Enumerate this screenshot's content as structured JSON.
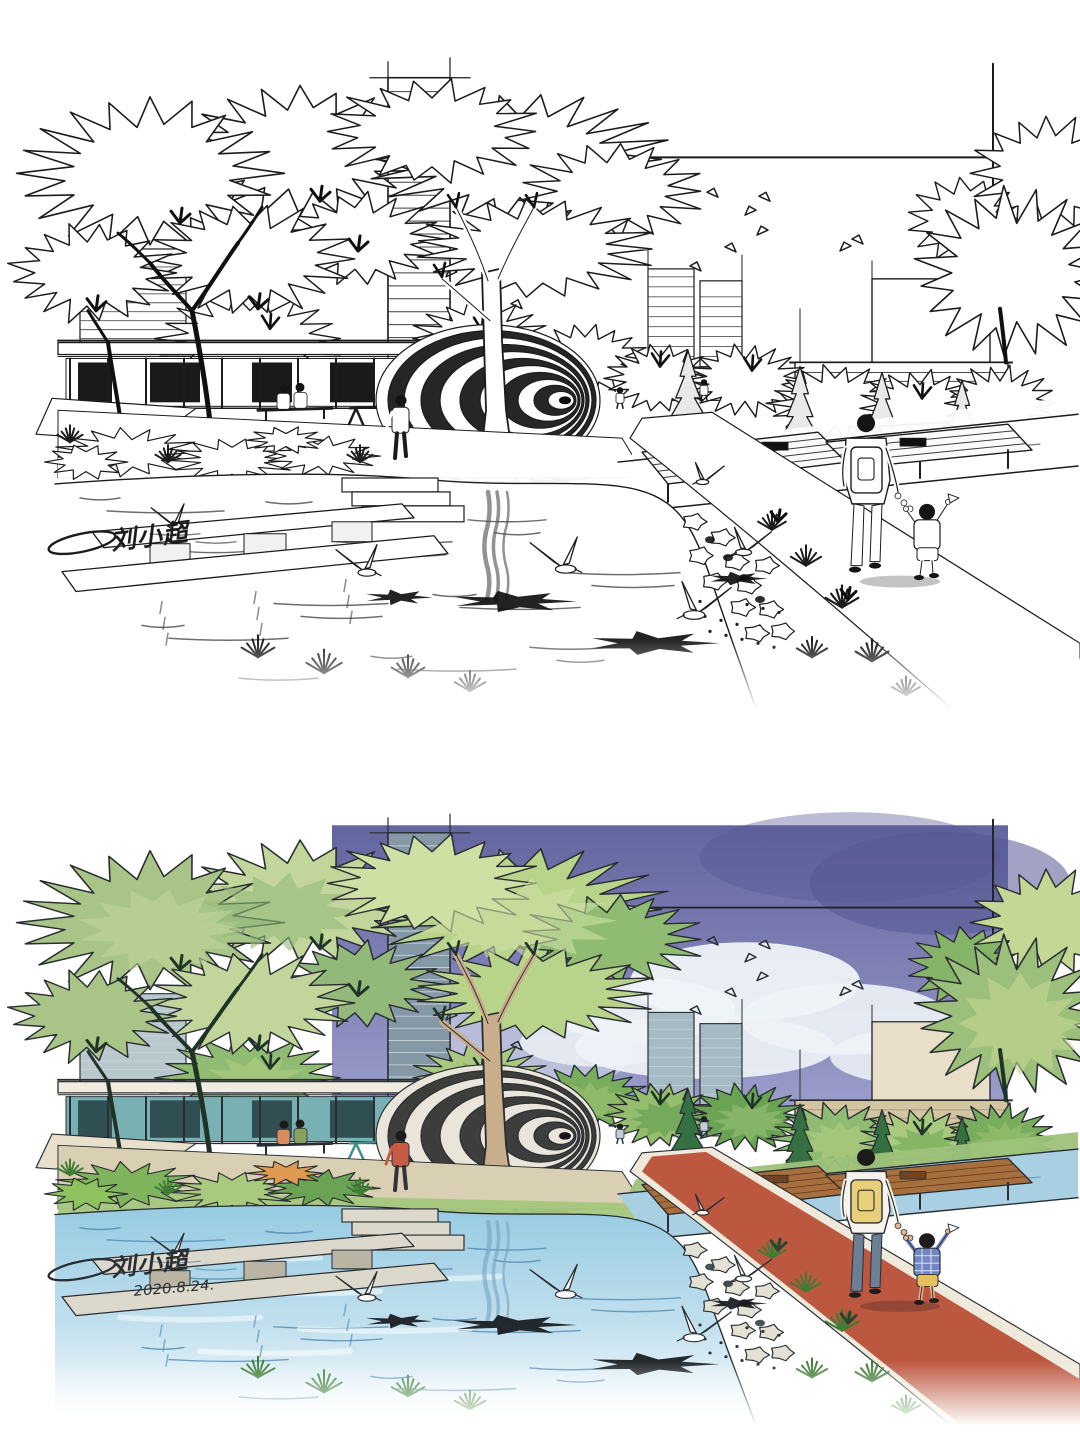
{
  "page": {
    "sheet_background": "#ffffff"
  },
  "artworks": [
    {
      "id": "ink-line-sketch",
      "medium": "black ink line sketch",
      "signature": "刘小超",
      "date": "",
      "palette_key": "ink"
    },
    {
      "id": "marker-color-rendering",
      "medium": "watercolor marker rendering",
      "signature": "刘小超",
      "date": "2020.8.24.",
      "palette_key": "color"
    }
  ],
  "scene_subjects": [
    "park waterfront plaza",
    "egg-shaped ribbed pavilion",
    "large spiky-canopy trees",
    "city towers skyline",
    "flying birds",
    "glass pavilion building",
    "swing frames",
    "stepping-stone concrete piers",
    "pond with white egrets and shadows",
    "wooden deck over canal",
    "red walking path",
    "stone edge and gravel",
    "ornamental grasses",
    "adult with backpack holding child's hand",
    "sitting couple on bench",
    "person in red shirt",
    "artist signature and date"
  ],
  "palettes": {
    "ink": {
      "ink": "#1c1c1c",
      "frame": "#1c1c1c",
      "towerFill": "#ffffff",
      "towerLine": "#2a2a2a",
      "lowriseFill": "#ffffff",
      "rtowerFill": "#ffffff",
      "tanFill": "#ffffff",
      "tanLine": "#2a2a2a",
      "penthouseFill": "#ffffff",
      "band": [
        "#ffffff",
        "#ffffff",
        "#ffffff",
        "#ffffff",
        "#ffffff"
      ],
      "conifer": "#e9e9e9",
      "branch": "#101010",
      "canopyLeft": [
        "#ffffff",
        "#ffffff",
        "#ffffff"
      ],
      "canopyCenter": [
        "#ffffff",
        "#ffffff",
        "#ffffff"
      ],
      "canopyRight": [
        "#ffffff",
        "#ffffff",
        "#ffffff"
      ],
      "trunk": "#ffffff",
      "roof": "#ffffff",
      "glass": "#ffffff",
      "glassDark": "#1a1a1a",
      "awning": "#ffffff",
      "swing": "#1c1c1c",
      "eggLight": "#ffffff",
      "eggDark": "#262626",
      "eggCore": "#0d0d0d",
      "eggShadowOpacity": 0.85,
      "paving": "#ffffff",
      "lawn": "#ffffff",
      "beds": [
        "#ffffff",
        "#ffffff",
        "#ffffff",
        "#ffffff"
      ],
      "orange": "#ffffff",
      "grass": "#1c1c1c",
      "grassDark": "#0f0f0f",
      "bank": "#ffffff",
      "canal": "#ffffff",
      "deck": "#fbfbfb",
      "deckLine": "#1c1c1c",
      "deckTable": "#111111",
      "path": "#ffffff",
      "curb": "#ffffff",
      "waterTop": "#ffffff",
      "waterMid": "#ffffff",
      "waterBottom": "#ffffff",
      "ripple": "#3c3c3c",
      "streak": null,
      "reflect": "#4a4a4a",
      "concrete": "#ffffff",
      "concreteSide": "#f1f1f1",
      "stone": "#ffffff",
      "gravel": "#141414",
      "shadow": "#101010",
      "skyTop": null,
      "skyBottom": null,
      "skyBlob": null,
      "cloud": null,
      "skin": "#ffffff",
      "hair": "#141414",
      "shirt": "#ffffff",
      "backpack": "#ffffff",
      "pants": "#ffffff",
      "childTop": "#ffffff",
      "childPlaid": null,
      "childShorts": "#ffffff",
      "legRed": "#1c1c1c",
      "red1": "#ffffff",
      "benchA": "#ffffff",
      "benchB": "#ffffff",
      "smallFig": "#ffffff"
    },
    "color": {
      "ink": "#2a2e33",
      "frame": "#22262b",
      "towerFill": "#8498a6",
      "towerLine": "#ccd9de",
      "lowriseFill": "#b9c8cd",
      "rtowerFill": "#a6bac4",
      "tanFill": "#d3c5a2",
      "tanLine": "#a4967a",
      "penthouseFill": "#e9dfc8",
      "band": [
        "#8fbb72",
        "#a9c97e",
        "#79ad5e",
        "#95bd6e",
        "#6ba355"
      ],
      "conifer": "#357042",
      "branch": "#1f3326",
      "canopyLeft": [
        "#a9c487",
        "#c2d69b",
        "#93b97a"
      ],
      "canopyCenter": [
        "#b8d48a",
        "#cfe0a4",
        "#8fbb72"
      ],
      "canopyRight": [
        "#9cc07c",
        "#c4d795",
        "#85b468"
      ],
      "trunk": "#c9ae8c",
      "roof": "#f1ece0",
      "glass": "#79b0b4",
      "glassDark": "#2f4f52",
      "awning": "#e9e0cc",
      "swing": "#3f8f8a",
      "eggLight": "#e9e5da",
      "eggDark": "#3d3d3b",
      "eggCore": "#15151a",
      "eggShadowOpacity": 0.4,
      "paving": "#d9cfb2",
      "lawn": "#a5c77e",
      "beds": [
        "#7fb35c",
        "#a9c97e",
        "#6ba355",
        "#8fc25e"
      ],
      "orange": "#df9a52",
      "grass": "#3f7c35",
      "grassDark": "#27462d",
      "bank": "#9ec27a",
      "canal": "#a8cfe2",
      "deck": "#a86f3e",
      "deckLine": "#5e3a1d",
      "deckTable": "#6e4423",
      "path": "#bc5740",
      "curb": "#efe9dc",
      "waterTop": "#96cbe2",
      "waterMid": "#c2e0ee",
      "waterBottom": "#ffffff",
      "ripple": "#4a86ad",
      "streak": "#ffffff",
      "reflect": "#74a3bf",
      "concrete": "#dcd8cb",
      "concreteSide": "#b9b4a4",
      "stone": "#e3e0d4",
      "gravel": "#3a3f45",
      "shadow": "#15181c",
      "skyTop": "#63659f",
      "skyBottom": "#9b9dcb",
      "skyBlob": "#565894",
      "cloud": "#eef3f7",
      "skin": "#e8b48e",
      "hair": "#1c1c1c",
      "shirt": "#f5f3ec",
      "backpack": "#e8cf7a",
      "pants": "#6d7f94",
      "childTop": "#7286c4",
      "childPlaid": "#e8ecf5",
      "childShorts": "#e3c05a",
      "legRed": "#30343a",
      "red1": "#c75b45",
      "benchA": "#d98d5a",
      "benchB": "#89a25f",
      "smallFig": "#c0ccd8"
    }
  }
}
